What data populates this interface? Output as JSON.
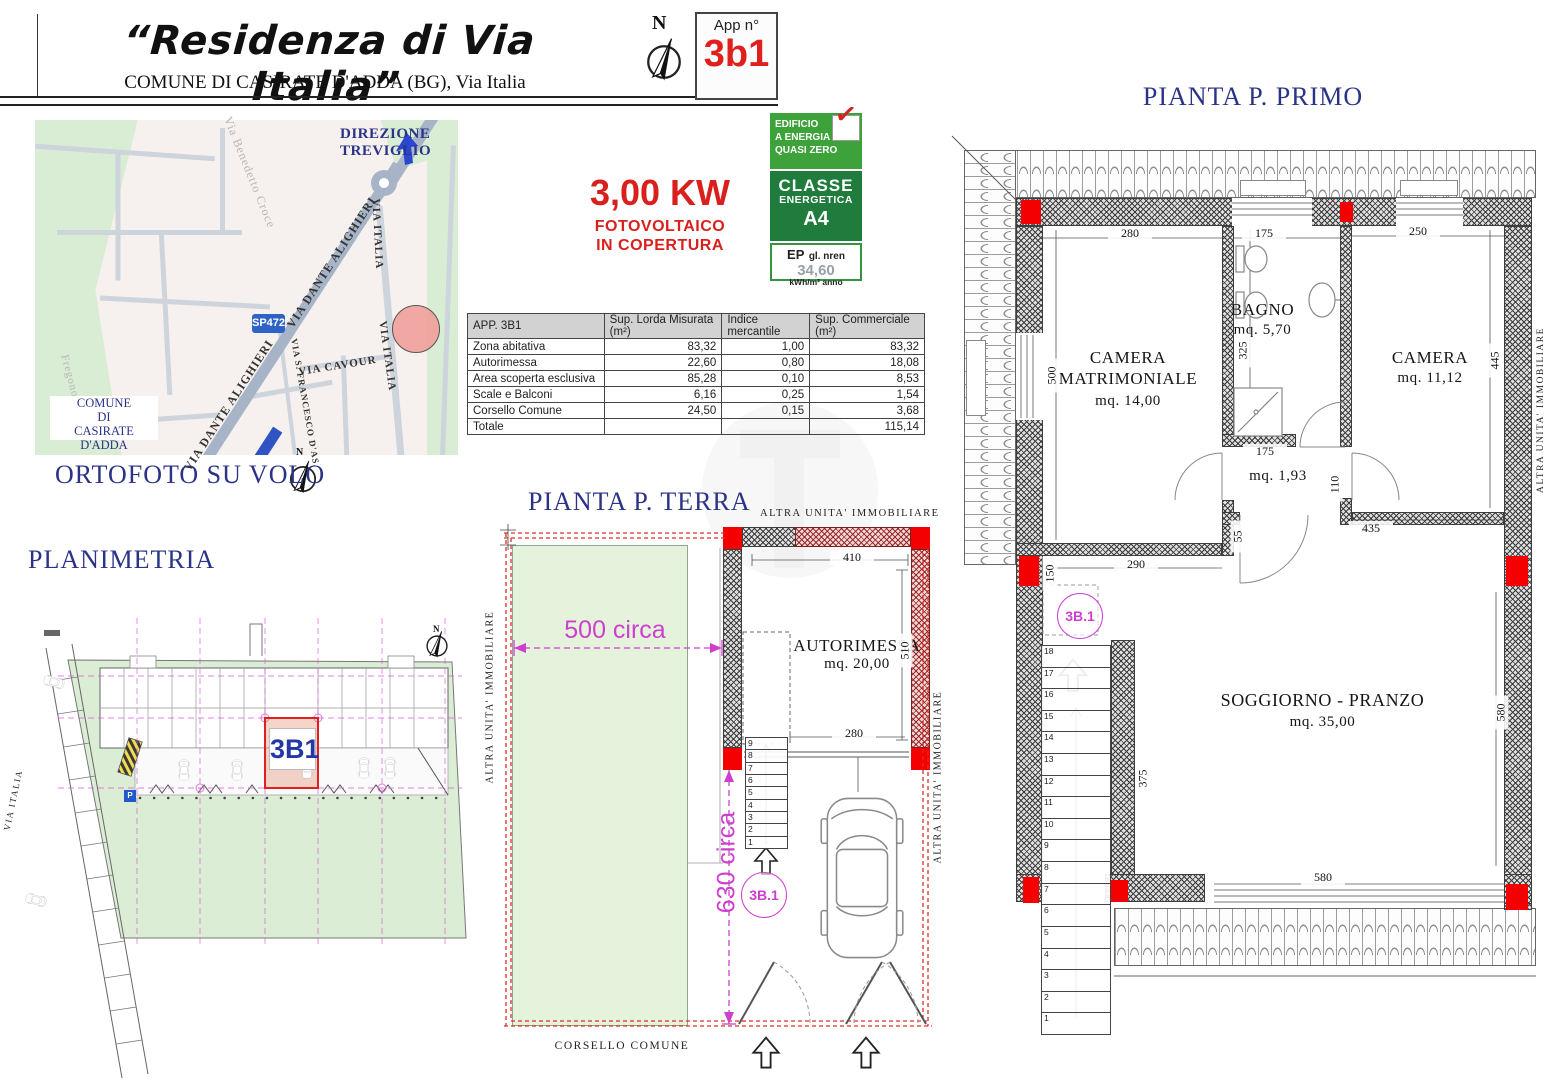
{
  "north": "N",
  "colors": {
    "navy": "#2b3387",
    "red": "#e0201d",
    "magenta": "#cf3fcf",
    "energy_green": "#3ea23b",
    "energy_dark_green": "#1f7c3d",
    "garden_green": "#e6f3dc",
    "pillar_red": "#ff0000",
    "road_blue": "#2e62c4"
  },
  "header": {
    "title": "“Residenza di Via Italia”",
    "subtitle": "COMUNE DI CASIRATE D'ADDA (BG), Via Italia",
    "app_label": "App n°",
    "app_number": "3b1"
  },
  "map": {
    "direction": "DIREZIONE TREVIGLIO",
    "sp472": "SP472",
    "street_dante": "VIA DANTE ALIGHIERI",
    "street_italia": "VIA ITALIA",
    "street_cavour": "VIA CAVOUR",
    "street_francesco": "VIA S. FRANCESCO D'AS.",
    "street_benedetto": "Via Benedetto Croce",
    "street_fregono": "Fregono",
    "comune_line1": "COMUNE",
    "comune_line2": "DI",
    "comune_line3": "CASIRATE D'ADDA",
    "caption": "ORTOFOTO SU VOLO"
  },
  "photovoltaic": {
    "power": "3,00 KW",
    "line1": "FOTOVOLTAICO",
    "line2": "IN COPERTURA"
  },
  "energy": {
    "nzeb_line1": "EDIFICIO",
    "nzeb_line2": "A ENERGIA",
    "nzeb_line3": "QUASI ZERO",
    "check": "✓",
    "class_line1": "CLASSE",
    "class_line2": "ENERGETICA",
    "class_value": "A4",
    "ep_label": "EP",
    "ep_sublabel": "gl. nren",
    "ep_value": "34,60",
    "ep_unit": "kWh/m² anno"
  },
  "table": {
    "headers": [
      "APP. 3B1",
      "Sup. Lorda Misurata (m²)",
      "Indice mercantile",
      "Sup. Commerciale (m²)"
    ],
    "rows": [
      [
        "Zona abitativa",
        "83,32",
        "1,00",
        "83,32"
      ],
      [
        "Autorimessa",
        "22,60",
        "0,80",
        "18,08"
      ],
      [
        "Area scoperta esclusiva",
        "85,28",
        "0,10",
        "8,53"
      ],
      [
        "Scale e Balconi",
        "6,16",
        "0,25",
        "1,54"
      ],
      [
        "Corsello Comune",
        "24,50",
        "0,15",
        "3,68"
      ],
      [
        "Totale",
        "",
        "",
        "115,14"
      ]
    ]
  },
  "planimetria": {
    "title": "PLANIMETRIA",
    "unit": "3B1",
    "street": "VIA ITALIA",
    "parking": "P"
  },
  "terra": {
    "title": "PIANTA P. TERRA",
    "altra_top": "ALTRA UNITA' IMMOBILIARE",
    "altra_left": "ALTRA UNITA' IMMOBILIARE",
    "altra_right": "ALTRA UNITA' IMMOBILIARE",
    "room": "AUTORIMESSA",
    "room_mq": "mq. 20,00",
    "dim_top": "410",
    "dim_right": "510",
    "dim_door": "280",
    "garden_width": "500 circa",
    "garden_height": "630 circa",
    "badge": "3B.1",
    "corsello": "CORSELLO COMUNE",
    "stairs": [
      "9",
      "8",
      "7",
      "6",
      "5",
      "4",
      "3",
      "2",
      "1"
    ]
  },
  "primo": {
    "title": "PIANTA P. PRIMO",
    "altra_right": "ALTRA UNITA' IMMOBILIARE",
    "badge": "3B.1",
    "rooms": {
      "matrimoniale_line1": "CAMERA",
      "matrimoniale_line2": "MATRIMONIALE",
      "matrimoniale_mq": "mq. 14,00",
      "bagno": "BAGNO",
      "bagno_mq": "mq. 5,70",
      "camera": "CAMERA",
      "camera_mq": "mq. 11,12",
      "disimpegno_mq": "mq. 1,93",
      "soggiorno": "SOGGIORNO - PRANZO",
      "soggiorno_mq": "mq. 35,00"
    },
    "dims": {
      "matr_w": "280",
      "bagno_w": "175",
      "camera_w": "250",
      "matr_h": "500",
      "bagno_h": "325",
      "camera_h": "445",
      "hall_w": "175",
      "hall_h": "110",
      "stub": "55",
      "sogg_top": "435",
      "matr_bottom": "290",
      "opening": "150",
      "stairs_h": "375",
      "sogg_right": "580",
      "balcony": "580"
    },
    "stairs": [
      "18",
      "17",
      "16",
      "15",
      "14",
      "13",
      "12",
      "11",
      "10",
      "9",
      "8",
      "7",
      "6",
      "5",
      "4",
      "3",
      "2",
      "1"
    ]
  }
}
